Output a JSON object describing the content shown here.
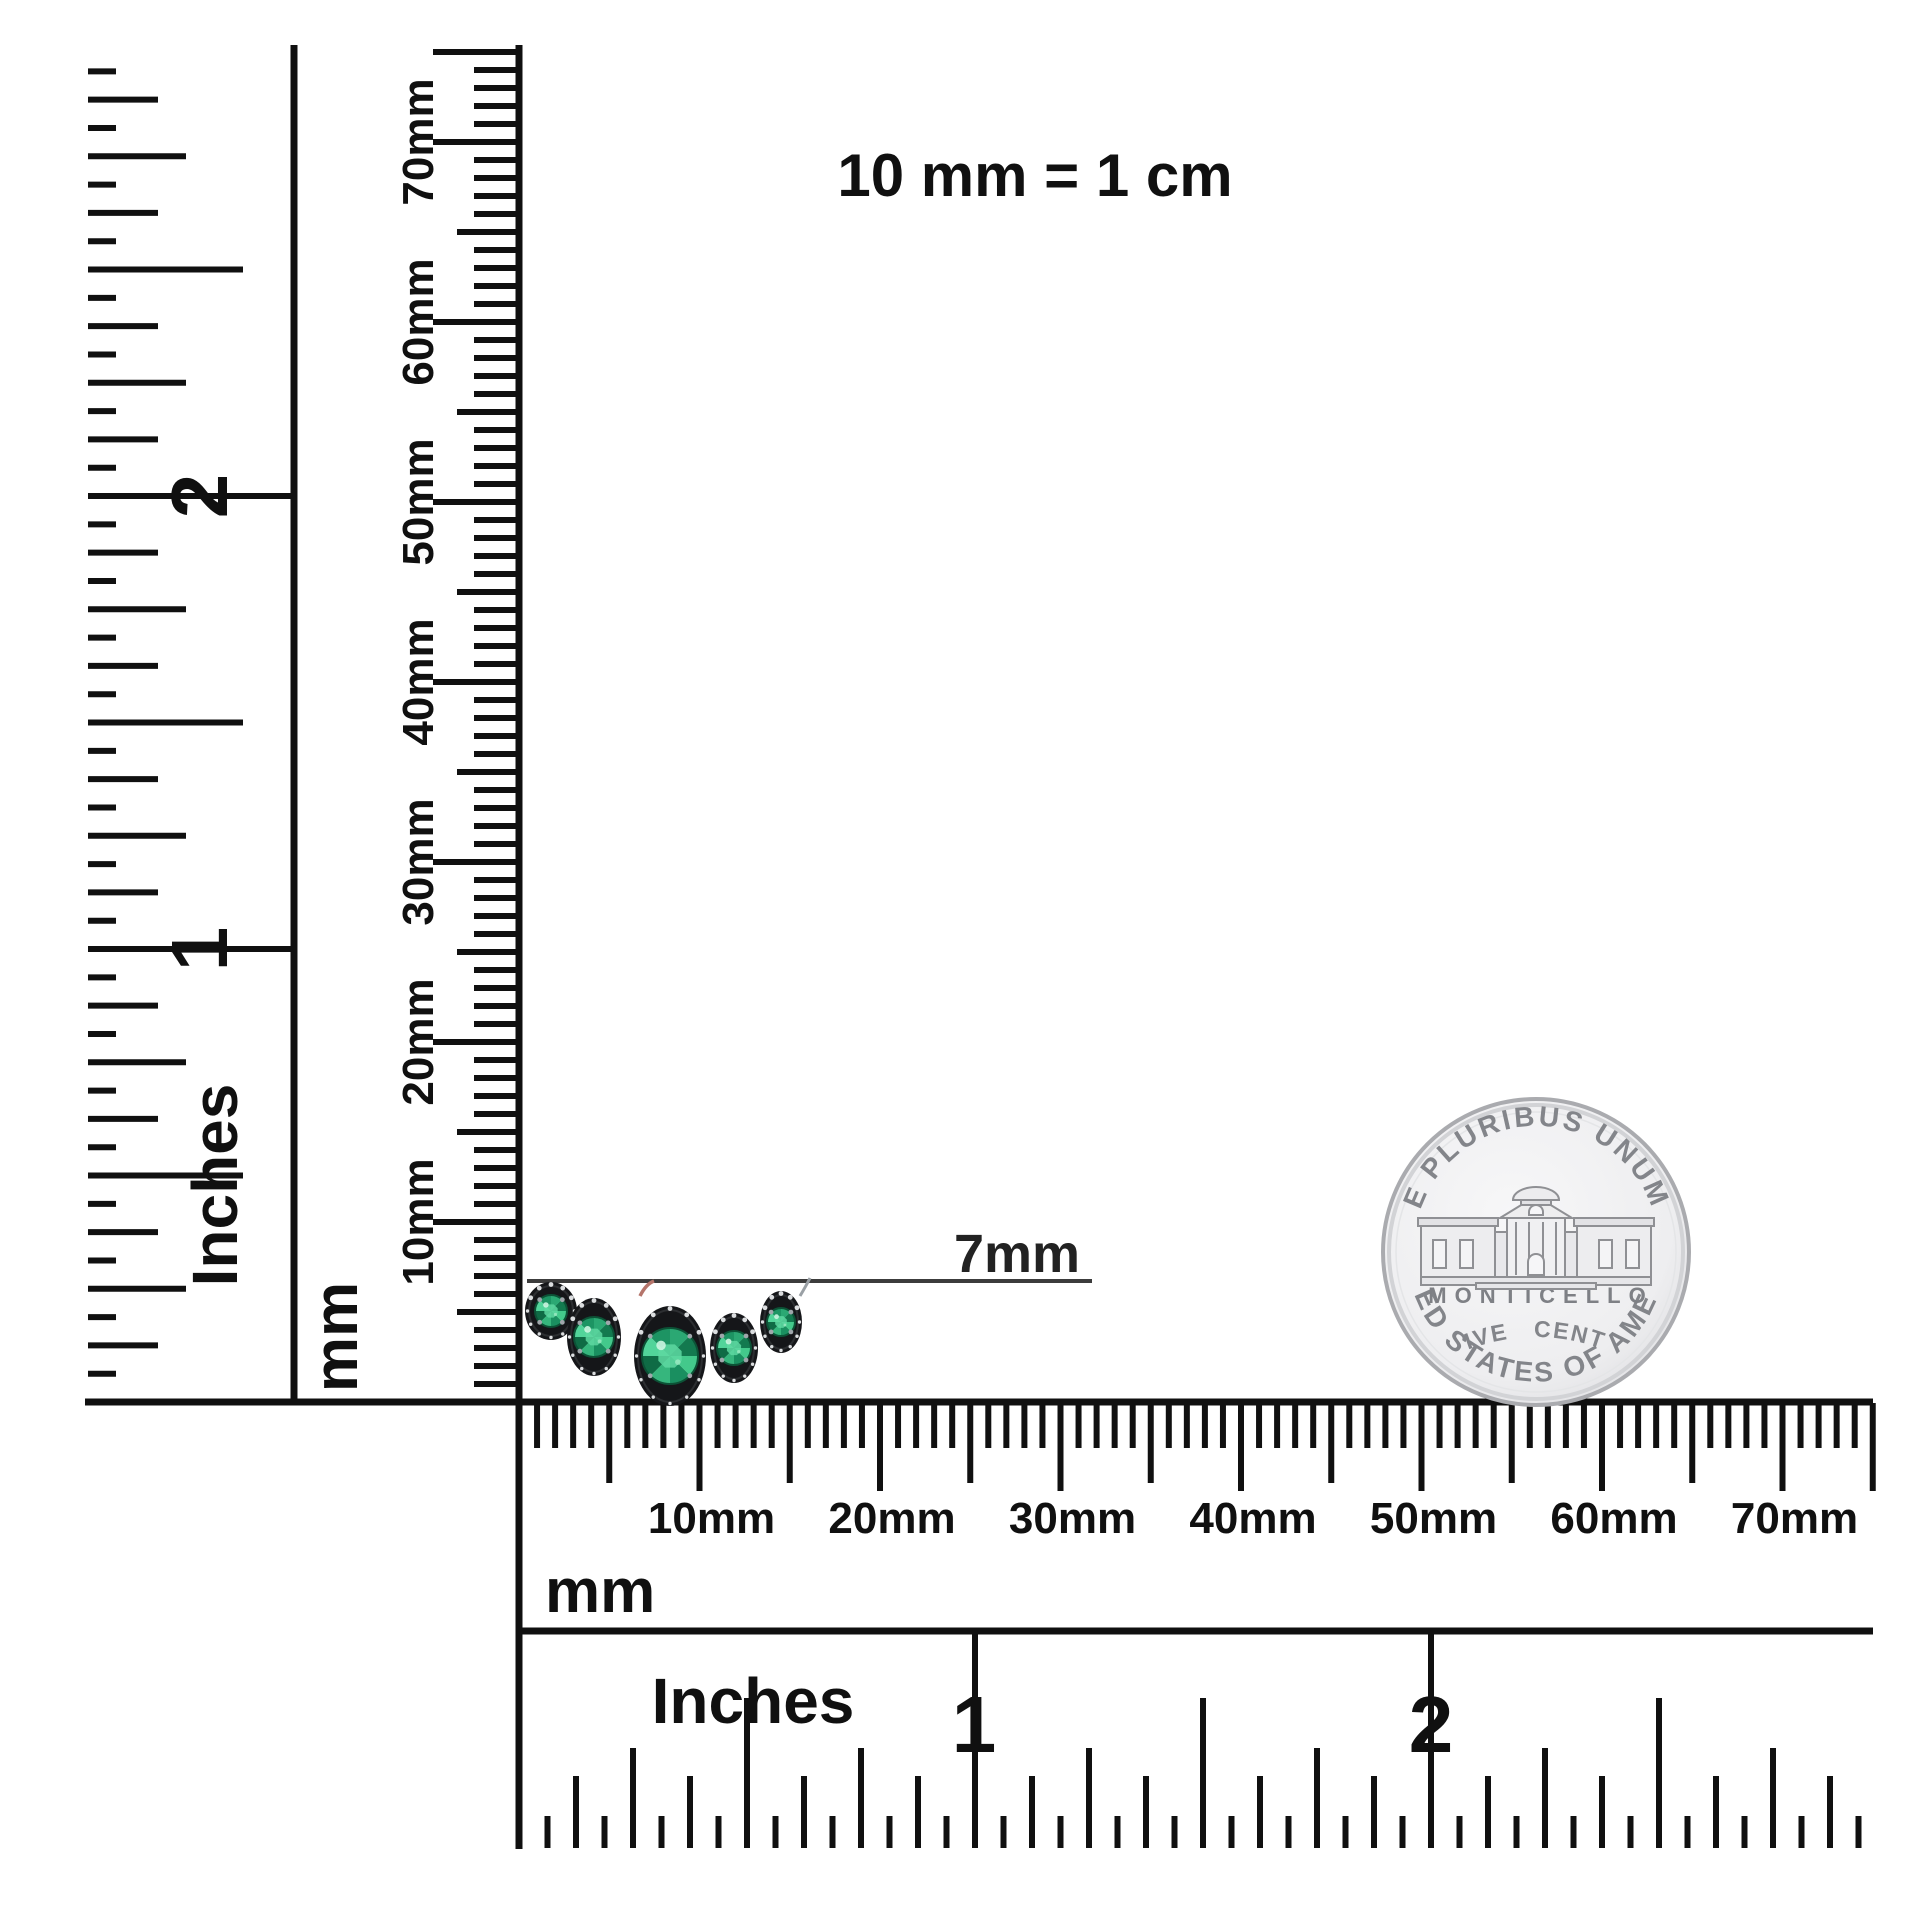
{
  "title": "10 mm = 1 cm",
  "annotation": {
    "label": "7mm"
  },
  "rulers": {
    "left_inches": {
      "unit": "Inches",
      "numbers": [
        "1",
        "2"
      ],
      "max_sixteenths": 47
    },
    "left_mm": {
      "unit": "mm",
      "labels": [
        "10mm",
        "20mm",
        "30mm",
        "40mm",
        "50mm",
        "60mm",
        "70mm"
      ],
      "max_mm": 75
    },
    "bottom_mm": {
      "unit": "mm",
      "labels": [
        "10mm",
        "20mm",
        "30mm",
        "40mm",
        "50mm",
        "60mm",
        "70mm"
      ],
      "max_mm": 75
    },
    "bottom_inches": {
      "unit": "Inches",
      "numbers": [
        "1",
        "2"
      ],
      "max_sixteenths": 47
    }
  },
  "coin": {
    "motto": "E PLURIBUS UNUM",
    "building": "MONTICELLO",
    "denomination": "FIVE CENTS",
    "country": "UNITED STATES OF AMERICA"
  },
  "jewelry": {
    "description": "five round emeralds in dark halo bezels",
    "stones": [
      {
        "cx": 551,
        "cy": 1311,
        "rx": 26,
        "ry": 29,
        "gem": 16
      },
      {
        "cx": 594,
        "cy": 1337,
        "rx": 27,
        "ry": 39,
        "gem": 20
      },
      {
        "cx": 670,
        "cy": 1356,
        "rx": 36,
        "ry": 50,
        "gem": 28
      },
      {
        "cx": 734,
        "cy": 1348,
        "rx": 24,
        "ry": 35,
        "gem": 17
      },
      {
        "cx": 781,
        "cy": 1322,
        "rx": 21,
        "ry": 31,
        "gem": 14
      }
    ]
  },
  "colors": {
    "ink": "#101010",
    "annotation_line": "#3c3c3c",
    "bezel": "#151619",
    "bezel_rim": "#2c2e31",
    "gem_base": "#1d9463",
    "gem_facets": [
      "#2ba873",
      "#13794f",
      "#43c98b",
      "#1a8f60",
      "#36b67d",
      "#0f6b45",
      "#52d49a",
      "#1d9463"
    ],
    "gem_table": "#5ed8a1",
    "halo_dot": "#e6e8ea",
    "prong": "#9fa6ab",
    "coin_face": "#f1f1f3",
    "coin_rim": "#aaabaf",
    "coin_line": "#8f9094",
    "wire": "#b5756b"
  }
}
